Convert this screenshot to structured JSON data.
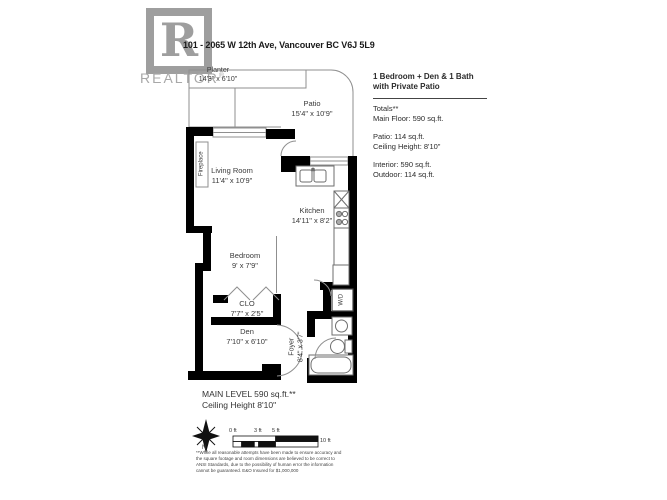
{
  "header": {
    "address": "101 - 2065 W 12th Ave, Vancouver BC V6J 5L9",
    "logo_letter": "R",
    "logo_brand": "REALTOR",
    "logo_registered": "®"
  },
  "info": {
    "title1": "1 Bedroom + Den & 1 Bath",
    "title2": "with Private Patio",
    "totals": "Totals**",
    "main_floor": "Main Floor: 590 sq.ft.",
    "patio": "Patio: 114 sq.ft.",
    "ceiling": "Ceiling Height: 8'10\"",
    "interior": "Interior: 590 sq.ft.",
    "outdoor": "Outdoor: 114 sq.ft."
  },
  "rooms": {
    "planter": {
      "name": "Planter",
      "dims": "14'3\" x 6'10\""
    },
    "patio": {
      "name": "Patio",
      "dims": "15'4\" x 10'9\""
    },
    "living": {
      "name": "Living Room",
      "dims": "11'4\" x 10'9\""
    },
    "kitchen": {
      "name": "Kitchen",
      "dims": "14'11\" x 8'2\""
    },
    "bedroom": {
      "name": "Bedroom",
      "dims": "9' x 7'9\""
    },
    "closet": {
      "name": "CLO",
      "dims": "7'7\" x 2'5\""
    },
    "den": {
      "name": "Den",
      "dims": "7'10\" x 6'10\""
    },
    "foyer": {
      "name": "Foyer",
      "dims": "8'4\" x 3'7\""
    }
  },
  "fixtures": {
    "fireplace": "Fireplace",
    "washer_dryer": "W/D"
  },
  "footer": {
    "main_level": "MAIN LEVEL 590 sq.ft.**",
    "ceiling": "Ceiling Height 8'10\"",
    "north": "N",
    "scale_labels": [
      "0 ft",
      "3 ft",
      "5 ft",
      "10 ft"
    ],
    "disclaimer": "**While all reasonable attempts have been made to ensure accuracy and the square footage and room dimensions are believed to be correct to ANSI Standards, due to the possibility of human error the information cannot be guaranteed. E&O Insured for $1,000,000"
  },
  "colors": {
    "wall": "#000000",
    "thin_line": "#8f8f8f",
    "fixture_line": "#6e6e6e",
    "logo_grey": "#9e9e9e"
  }
}
